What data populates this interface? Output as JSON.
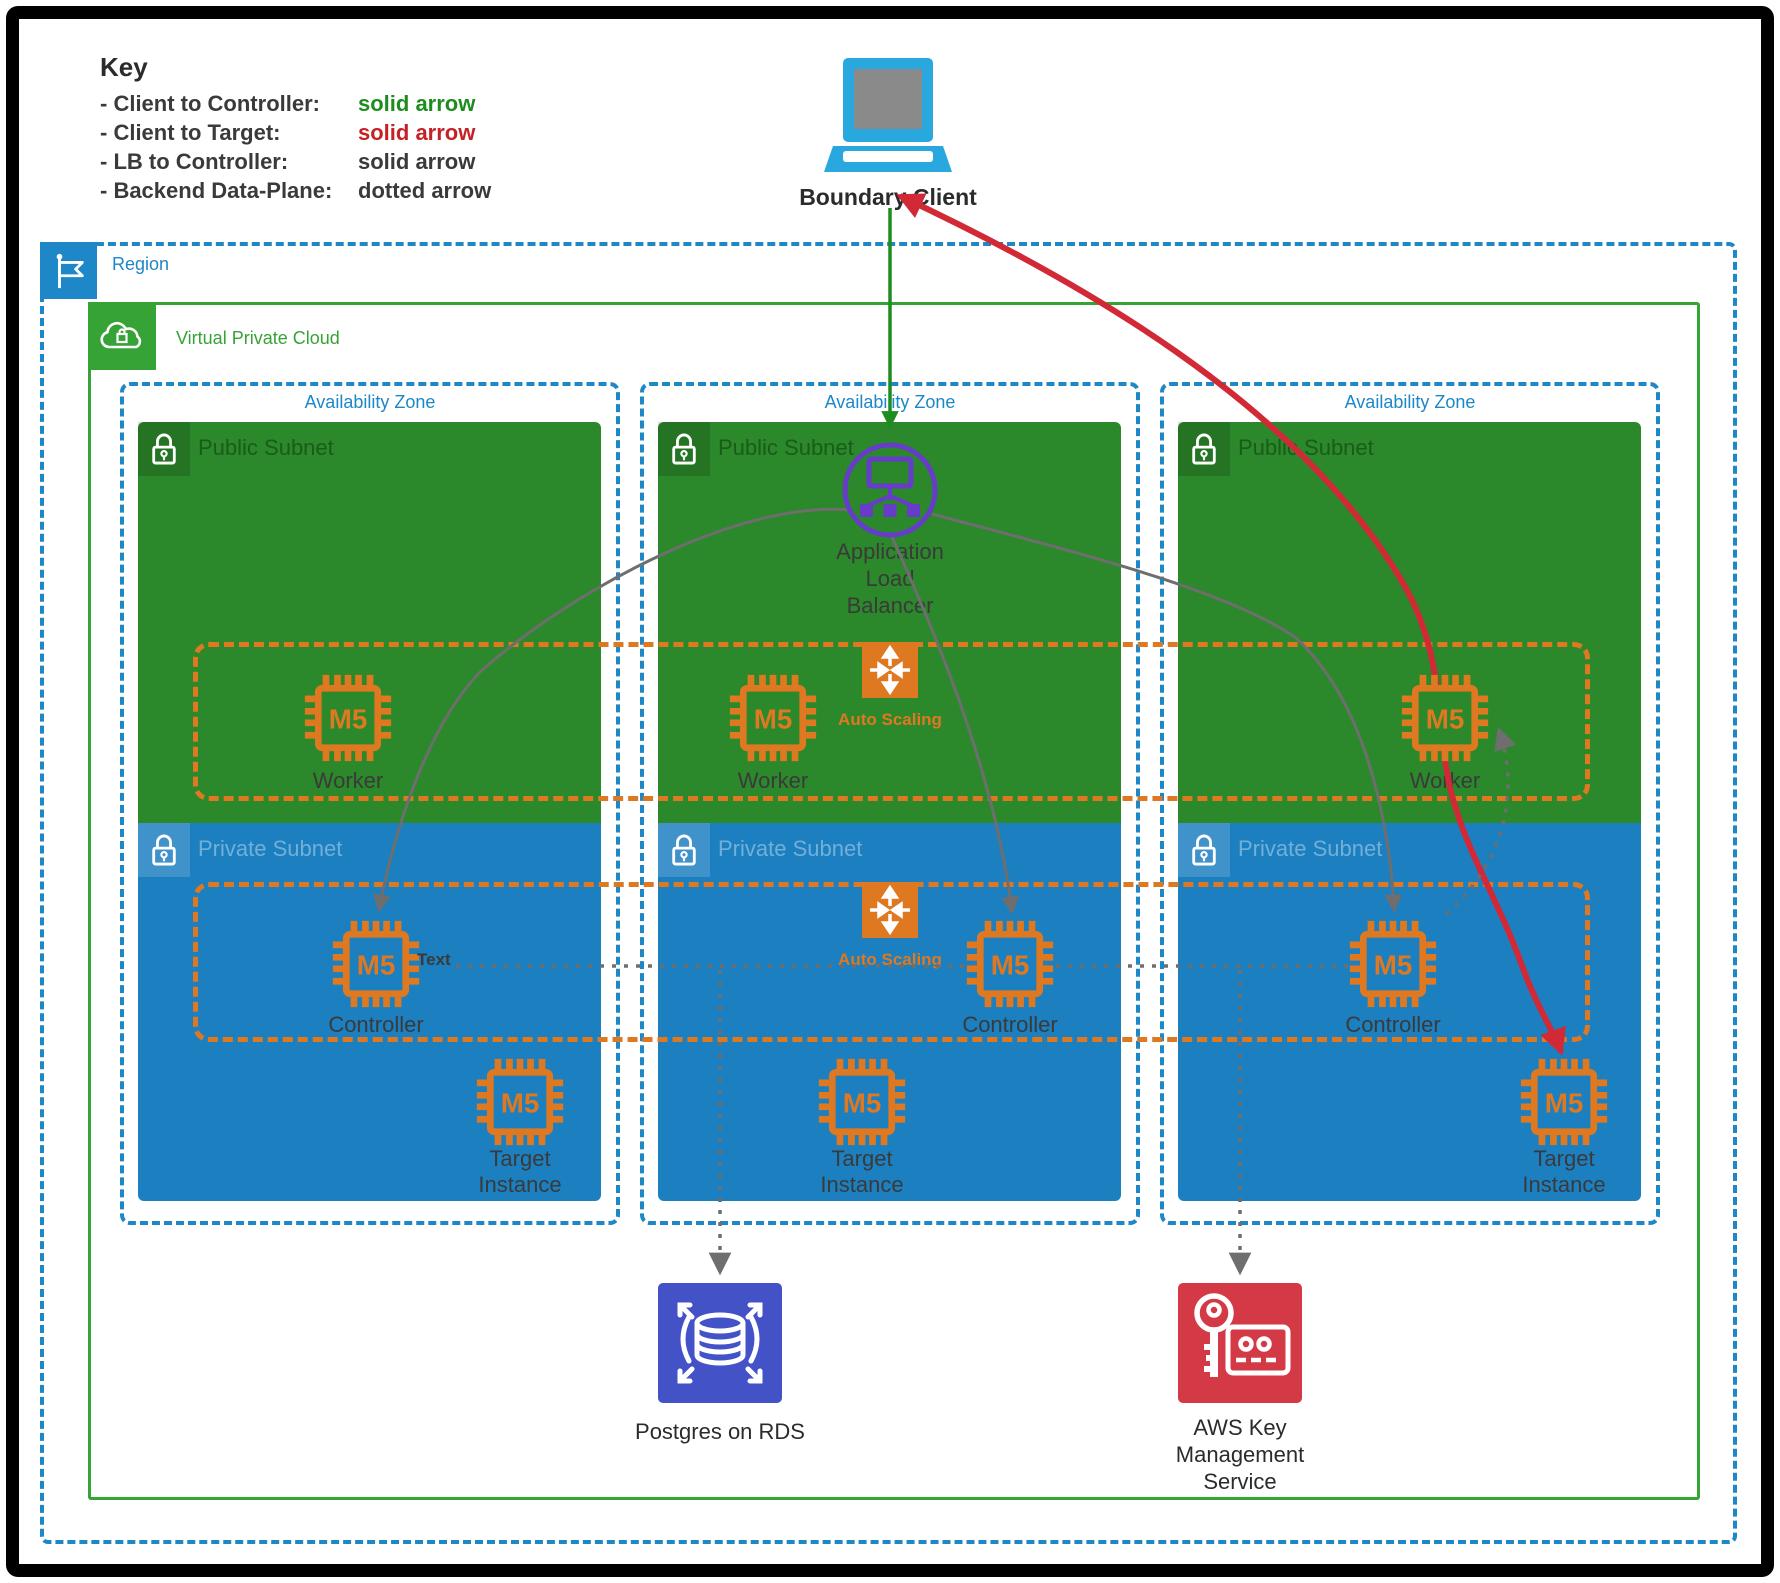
{
  "key": {
    "title": "Key",
    "rows": [
      {
        "label": "- Client to Controller:",
        "value": "solid arrow"
      },
      {
        "label": "- Client to Target:",
        "value": "solid arrow"
      },
      {
        "label": "- LB to Controller:",
        "value": "solid arrow"
      },
      {
        "label": "- Backend Data-Plane:",
        "value": "dotted arrow"
      }
    ]
  },
  "client": {
    "label": "Boundary Client"
  },
  "region": {
    "label": "Region"
  },
  "vpc": {
    "label": "Virtual Private Cloud"
  },
  "alb": {
    "lines": [
      "Application",
      "Load",
      "Balancer"
    ]
  },
  "asg": {
    "worker_label": "Auto Scaling",
    "controller_label": "Auto Scaling"
  },
  "azs": [
    {
      "label": "Availability Zone",
      "public_subnet": "Public Subnet",
      "private_subnet": "Private Subnet",
      "worker": {
        "chip": "M5",
        "label": "Worker"
      },
      "controller": {
        "chip": "M5",
        "label": "Controller"
      },
      "target": {
        "chip": "M5",
        "lines": [
          "Target",
          "Instance"
        ]
      }
    },
    {
      "label": "Availability Zone",
      "public_subnet": "Public Subnet",
      "private_subnet": "Private Subnet",
      "worker": {
        "chip": "M5",
        "label": "Worker"
      },
      "controller": {
        "chip": "M5",
        "label": "Controller"
      },
      "target": {
        "chip": "M5",
        "lines": [
          "Target",
          "Instance"
        ]
      }
    },
    {
      "label": "Availability Zone",
      "public_subnet": "Public Subnet",
      "private_subnet": "Private Subnet",
      "worker": {
        "chip": "M5",
        "label": "Worker"
      },
      "controller": {
        "chip": "M5",
        "label": "Controller"
      },
      "target": {
        "chip": "M5",
        "lines": [
          "Target",
          "Instance"
        ]
      }
    }
  ],
  "annotation": {
    "label": "Text"
  },
  "services": {
    "rds": {
      "label": "Postgres on RDS"
    },
    "kms": {
      "lines": [
        "AWS Key",
        "Management",
        "Service"
      ]
    }
  },
  "colors": {
    "subnet_green": "#2B882B",
    "vpc_green": "#36A336",
    "subnet_blue": "#1C7FC0",
    "zone_blue": "#1E87C8",
    "orange": "#DE7921",
    "alb_purple": "#663CC9",
    "arrow_red": "#D22937",
    "arrow_green": "#1E8C1E",
    "arrow_gray": "#6E6E6E",
    "rds_blue": "#4452C8",
    "kms_red": "#D43A46",
    "client_blue": "#29A8DF",
    "key_green": "#1E8C1E",
    "key_red": "#C42227",
    "text_dark": "#3A3A3A"
  }
}
